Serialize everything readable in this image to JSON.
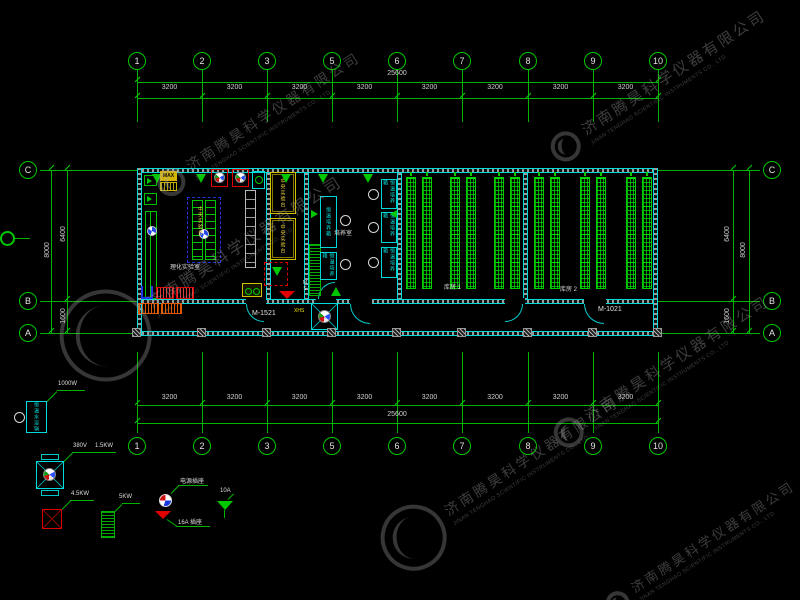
{
  "company": {
    "name_cn": "济南腾昊科学仪器有限公司",
    "name_en": "JINAN TENGHAO SCIENTIFIC INSTRUMENTS CO., LTD"
  },
  "axes": {
    "top": {
      "bubbles": [
        "1",
        "2",
        "3",
        "5",
        "6",
        "7",
        "8",
        "9",
        "10"
      ],
      "total": "25600",
      "segments": [
        "3200",
        "3200",
        "3200",
        "3200",
        "3200",
        "3200",
        "3200",
        "3200"
      ]
    },
    "bottom": {
      "bubbles": [
        "1",
        "2",
        "3",
        "5",
        "6",
        "7",
        "8",
        "9",
        "10"
      ],
      "total": "25600",
      "segments": [
        "3200",
        "3200",
        "3200",
        "3200",
        "3200",
        "3200",
        "3200",
        "3200"
      ]
    },
    "left": {
      "bubbles": [
        "C",
        "B",
        "A"
      ],
      "dim_total": "8000",
      "dim_upper": "6400",
      "dim_lower": "1600"
    },
    "right": {
      "bubbles": [
        "C",
        "B",
        "A"
      ],
      "dim_total": "8000",
      "dim_upper": "6400",
      "dim_lower": "1600"
    }
  },
  "plan": {
    "door_label_left": "M-1521",
    "door_label_right": "M-1021",
    "room1_label": "理化实验室",
    "room3_label": "培养室",
    "storage1_label": "库房 1",
    "storage2_label": "库房 2",
    "island_bench_label": "中央实验台",
    "fume_unit1_label": "中央实验台",
    "fume_unit2_label": "中央实验台",
    "incubator_label": "恒温培养箱",
    "hydrant_label": "XHS",
    "ms_label": "MS",
    "max_label": "MAX"
  },
  "legend": {
    "water_bath": {
      "box_text": "恒温水浴锅",
      "power": "1000W"
    },
    "fan": {
      "voltage": "380V",
      "power": "1.5KW"
    },
    "red_socket": {
      "power": "4.5KW"
    },
    "green_heater": {
      "power": "5KW"
    },
    "power_socket": {
      "label": "电源插座"
    },
    "socket_16a": {
      "label": "16A 插座"
    },
    "cone_10a": {
      "label": "10A"
    }
  },
  "colors": {
    "grid_green": "#00c800",
    "wall_cyan": "#00dcdc",
    "equipment_red": "#dd0000",
    "fume_yellow": "#cfc000",
    "dim_text": "#d0d0d0"
  }
}
